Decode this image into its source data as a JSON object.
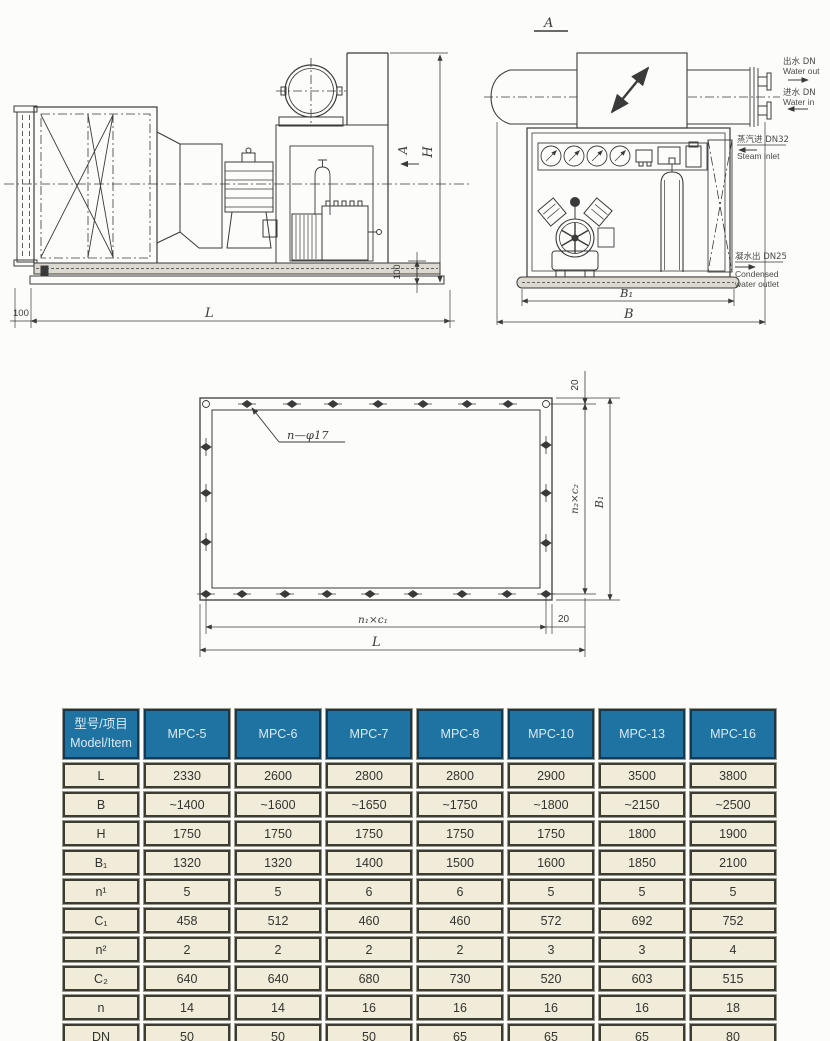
{
  "side_view": {
    "section_arrow_label": "A",
    "dim_height": "H",
    "dim_length": "L",
    "dim_base_height": "100",
    "dim_left_offset": "100"
  },
  "section_view": {
    "title": "A",
    "dim_b1": "B₁",
    "dim_b": "B",
    "annotations": {
      "water_out_zh": "出水 DN",
      "water_out_en": "Water out",
      "water_in_zh": "进水 DN",
      "water_in_en": "Water in",
      "steam_in_zh": "蒸汽进 DN32",
      "steam_in_en": "Steam inlet",
      "cond_out_zh": "凝水出 DN25",
      "cond_out_en1": "Condensed",
      "cond_out_en2": "water outlet"
    }
  },
  "flange_view": {
    "holes_label": "n—φ17",
    "dim_top_offset": "20",
    "dim_right_pitch": "n₂×c₂",
    "dim_height": "B₁",
    "dim_bottom_pitch": "n₁×c₁",
    "dim_length": "L",
    "dim_side_offset": "20"
  },
  "table": {
    "header": {
      "model_item_zh": "型号/项目",
      "model_item_en": "Model/Item",
      "models": [
        "MPC-5",
        "MPC-6",
        "MPC-7",
        "MPC-8",
        "MPC-10",
        "MPC-13",
        "MPC-16"
      ]
    },
    "rows": [
      {
        "label": "L",
        "values": [
          "2330",
          "2600",
          "2800",
          "2800",
          "2900",
          "3500",
          "3800"
        ]
      },
      {
        "label": "B",
        "values": [
          "~1400",
          "~1600",
          "~1650",
          "~1750",
          "~1800",
          "~2150",
          "~2500"
        ]
      },
      {
        "label": "H",
        "values": [
          "1750",
          "1750",
          "1750",
          "1750",
          "1750",
          "1800",
          "1900"
        ]
      },
      {
        "label": "B₁",
        "values": [
          "1320",
          "1320",
          "1400",
          "1500",
          "1600",
          "1850",
          "2100"
        ]
      },
      {
        "label": "n¹",
        "values": [
          "5",
          "5",
          "6",
          "6",
          "5",
          "5",
          "5"
        ]
      },
      {
        "label": "C₁",
        "values": [
          "458",
          "512",
          "460",
          "460",
          "572",
          "692",
          "752"
        ]
      },
      {
        "label": "n²",
        "values": [
          "2",
          "2",
          "2",
          "2",
          "3",
          "3",
          "4"
        ]
      },
      {
        "label": "C₂",
        "values": [
          "640",
          "640",
          "680",
          "730",
          "520",
          "603",
          "515"
        ]
      },
      {
        "label": "n",
        "values": [
          "14",
          "14",
          "16",
          "16",
          "16",
          "16",
          "18"
        ]
      },
      {
        "label": "DN",
        "values": [
          "50",
          "50",
          "50",
          "65",
          "65",
          "65",
          "80"
        ]
      }
    ]
  }
}
